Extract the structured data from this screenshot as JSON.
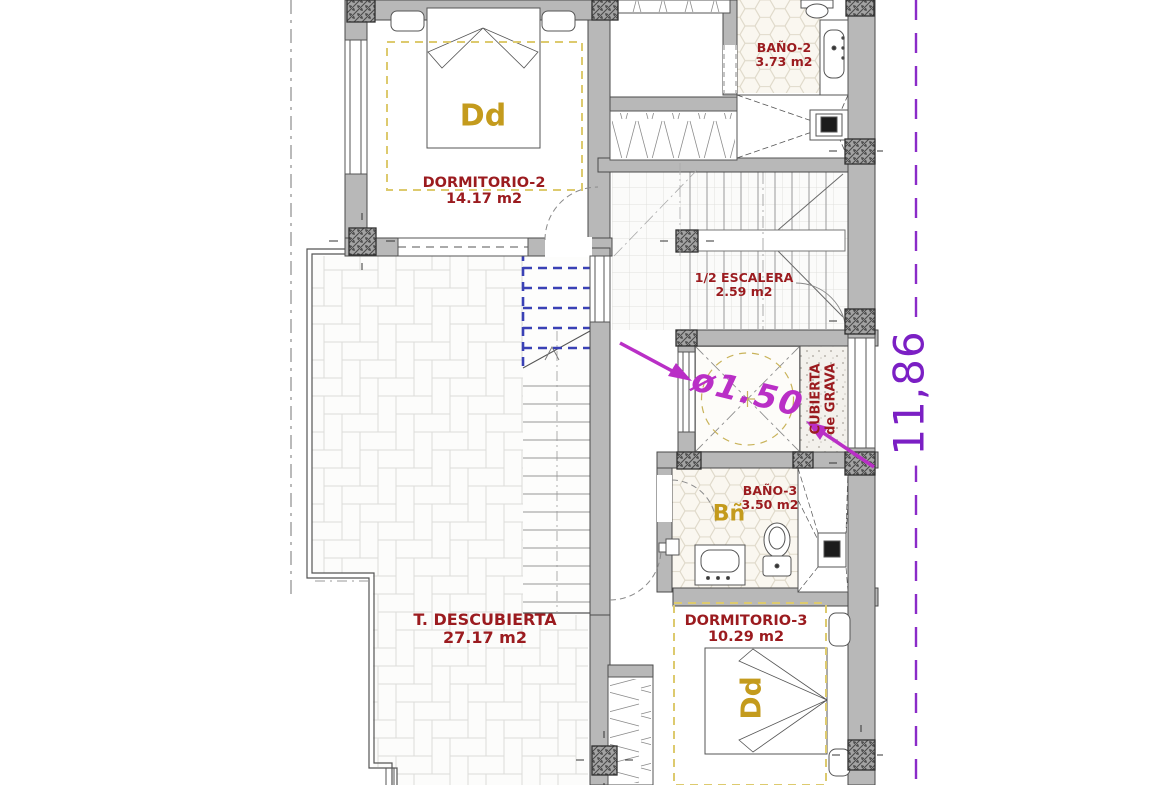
{
  "plan": {
    "rooms": {
      "dormitorio2": {
        "name": "DORMITORIO-2",
        "area": "14.17 m2",
        "tag": "Dd"
      },
      "bano2": {
        "name": "BAÑO-2",
        "area": "3.73 m2"
      },
      "escalera": {
        "name": "1/2 ESCALERA",
        "area": "2.59 m2"
      },
      "bano3": {
        "name": "BAÑO-3",
        "area": "3.50 m2",
        "tag": "Bñ"
      },
      "dormitorio3": {
        "name": "DORMITORIO-3",
        "area": "10.29 m2",
        "tag": "Dd"
      },
      "terraza": {
        "name": "T. DESCUBIERTA",
        "area": "27.17 m2"
      },
      "patio": {
        "diameter": "ø1.50",
        "cover_line1": "CUBIERTA",
        "cover_line2": "de GRAVA"
      }
    },
    "dimensions": {
      "height_total": "11,86"
    },
    "colors": {
      "room_label": "#9b1b1f",
      "room_tag": "#c49b1d",
      "diameter_annotation": "#b92fc6",
      "dimension_text": "#7b1fc4",
      "boundary_line": "#8a2bc8",
      "stair_dash": "#3a41b5",
      "room_outline_dash": "#ddca6e"
    }
  }
}
